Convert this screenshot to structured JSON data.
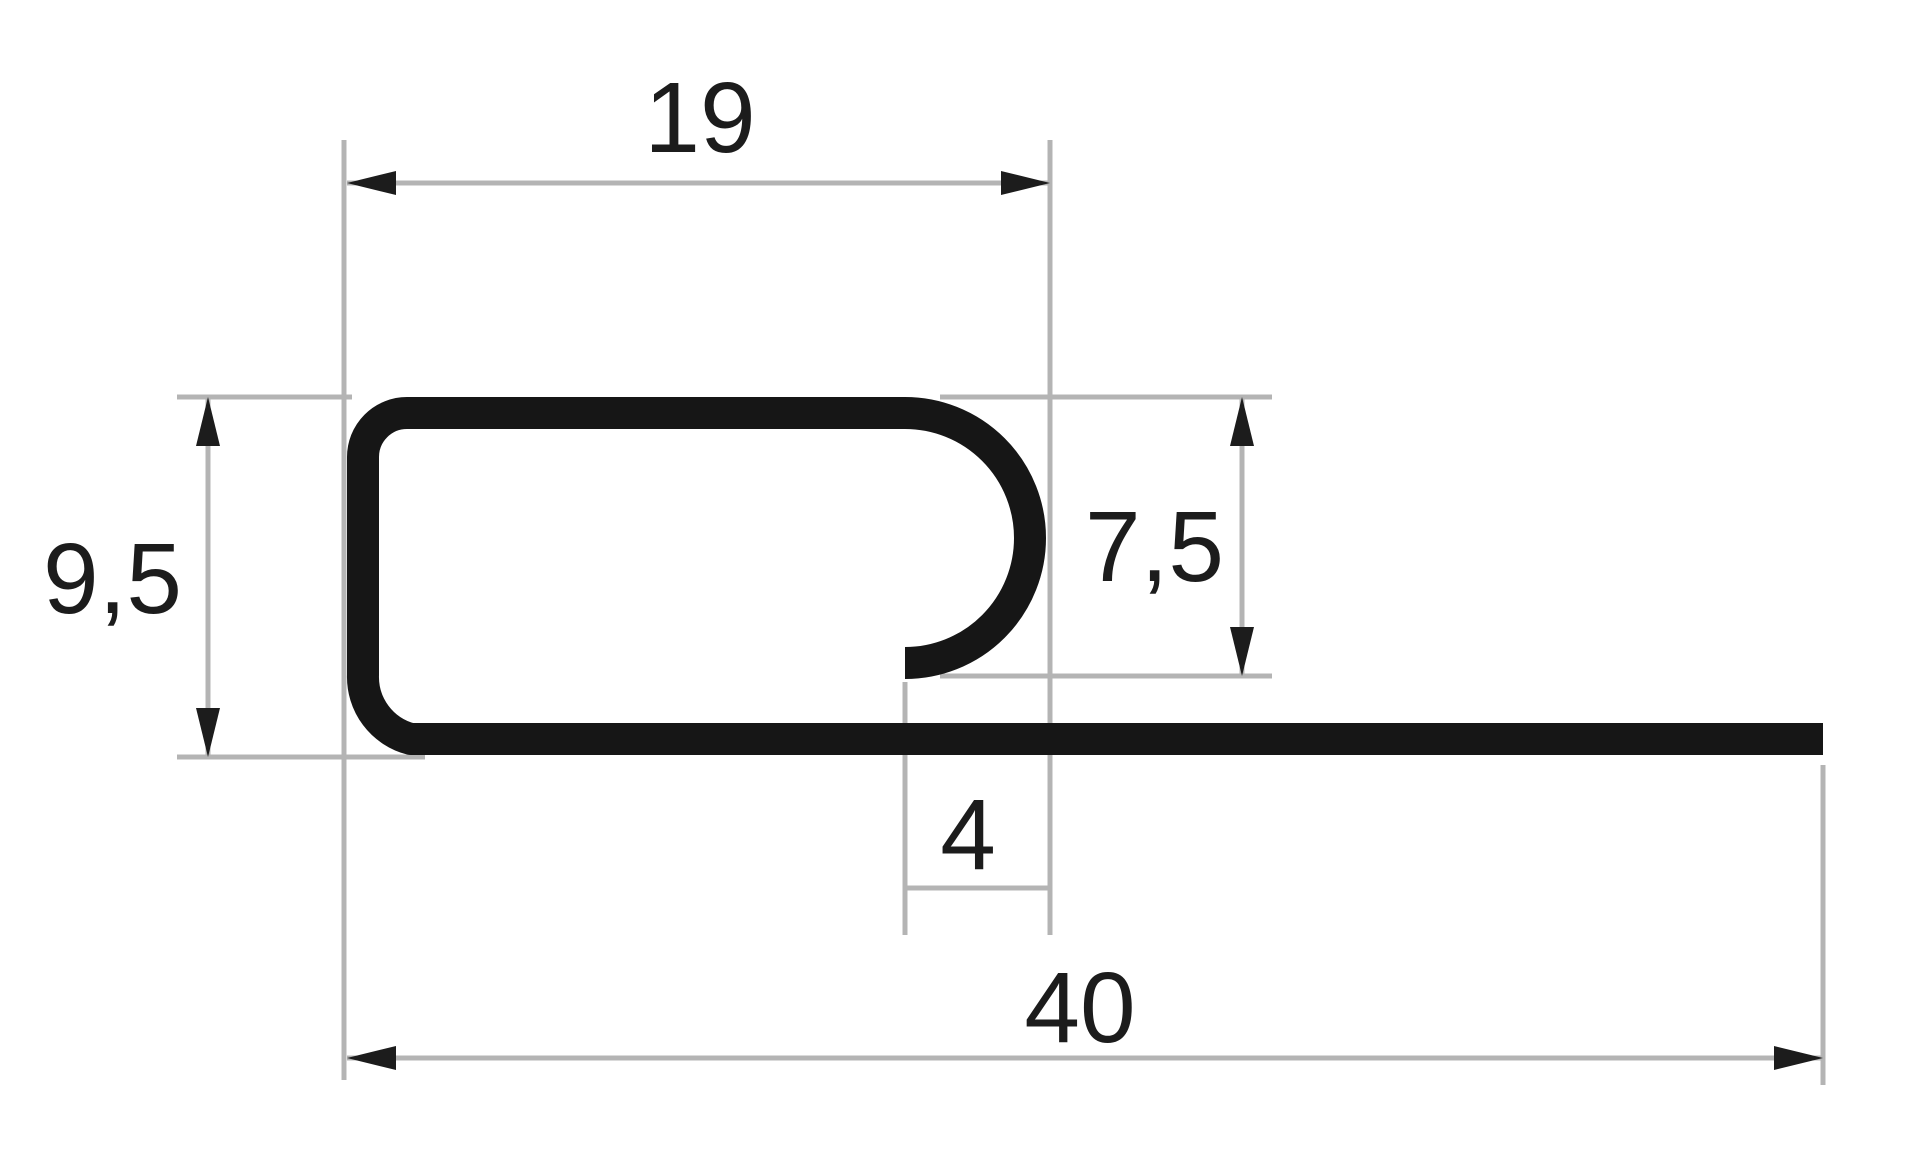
{
  "drawing": {
    "type": "dimensioned_profile_cross_section",
    "dimensions": {
      "top_width": {
        "value": 19,
        "label": "19"
      },
      "overall_height": {
        "value": 9.5,
        "label": "9,5"
      },
      "lip_height": {
        "value": 7.5,
        "label": "7,5"
      },
      "slot_width": {
        "value": 4,
        "label": "4"
      },
      "overall_width": {
        "value": 40,
        "label": "40"
      }
    },
    "colors": {
      "profile": "#161616",
      "line": "#b4b4b4",
      "text": "#1c1c1c",
      "background": "#ffffff"
    }
  }
}
